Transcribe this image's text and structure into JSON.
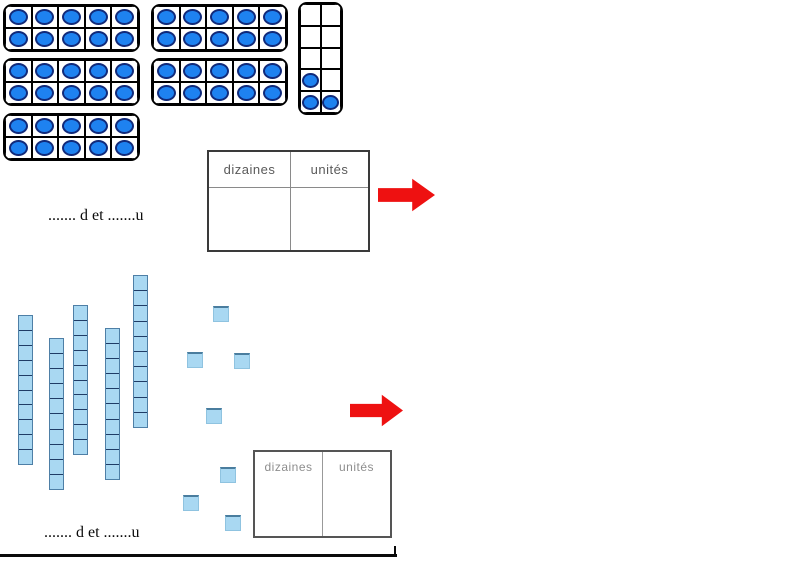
{
  "worksheet": {
    "section1": {
      "ten_frames": {
        "full_frames": 5,
        "dots_per_full_frame": 10,
        "partial_frame": {
          "rows": 5,
          "cols": 2,
          "dots": 3,
          "filled_cells": [
            [
              3,
              0
            ],
            [
              4,
              0
            ],
            [
              4,
              1
            ]
          ]
        },
        "total_dots": 53
      },
      "place_value_table": {
        "tens_header": "dizaines",
        "units_header": "unités"
      },
      "answer_line": "....... d et .......u"
    },
    "section2": {
      "base_ten_rods": {
        "count": 5,
        "segments_per_rod": 10
      },
      "unit_squares": {
        "count": 7
      },
      "total_value": 57,
      "place_value_table": {
        "tens_header": "dizaines",
        "units_header": "unités"
      },
      "answer_line": "....... d et .......u"
    }
  },
  "colors": {
    "dot_fill": "#1e82f0",
    "dot_outline": "#112a7a",
    "rod_fill": "#a9d8f2",
    "rod_separator": "#1f3c66",
    "unit_square_fill": "#a9d8f2",
    "arrow_red": "#ee1111",
    "table_border": "#3a3a3a",
    "header_text": "#5a5a5a"
  }
}
